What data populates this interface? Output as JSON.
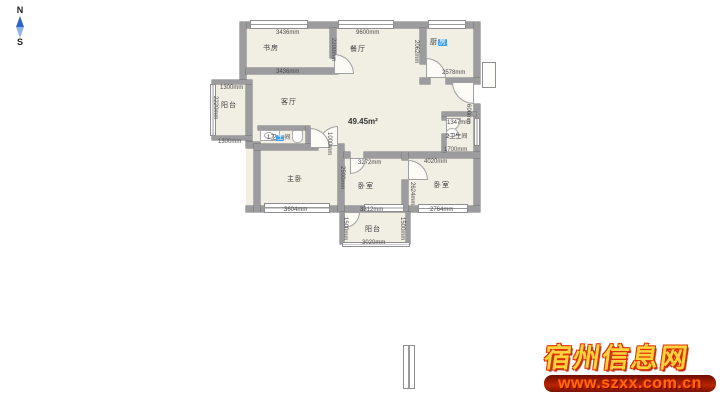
{
  "compass": {
    "north": "N",
    "south": "S"
  },
  "plan": {
    "area_label": "49.45m²",
    "rooms": {
      "study": {
        "label": "书房"
      },
      "dining": {
        "label": "餐厅"
      },
      "kitchen": {
        "pre": "厨",
        "hl": "房"
      },
      "living": {
        "label": "客厅"
      },
      "balcony_left": {
        "label": "阳台"
      },
      "bath1": {
        "pre": "1卫",
        "hl": "生",
        "post": "间"
      },
      "bath2": {
        "label": "2卫生间"
      },
      "master": {
        "label": "主卧"
      },
      "bedroom_mid": {
        "label": "卧室"
      },
      "bedroom_right": {
        "label": "卧室"
      },
      "balcony_bottom": {
        "label": "阳台"
      }
    },
    "dims": {
      "study_top": "3436mm",
      "study_bottom": "3436mm",
      "study_right": "2200mm",
      "top_width": "9600mm",
      "kitchen_bottom": "2578mm",
      "kitchen_left": "2062mm",
      "balcony_left_top": "1300mm",
      "balcony_left_bottom": "1300mm",
      "balcony_left_side": "2220mm",
      "bath2_top": "1347mm",
      "bath2_bottom": "1700mm",
      "bath2_side": "600mm",
      "door_width": "1000mm",
      "master_bottom": "3604mm",
      "master_side": "2500mm",
      "bedroom_mid_top": "3272mm",
      "bedroom_right_top": "4020mm",
      "bedroom_right_bottom": "2764mm",
      "bedroom_right_side": "2624mm",
      "balcony_bottom_top": "3312mm",
      "balcony_bottom_bottom": "3020mm",
      "balcony_bottom_left": "1500mm",
      "balcony_bottom_right": "1500mm"
    },
    "colors": {
      "wall": "#9c9c9e",
      "floor": "#f1eee3",
      "highlight": "#3d9ff0"
    }
  },
  "watermark": {
    "title": "宿州信息网",
    "url": "www.szxx.com.cn",
    "gold": "#ffd23f",
    "red": "#dd3300"
  }
}
